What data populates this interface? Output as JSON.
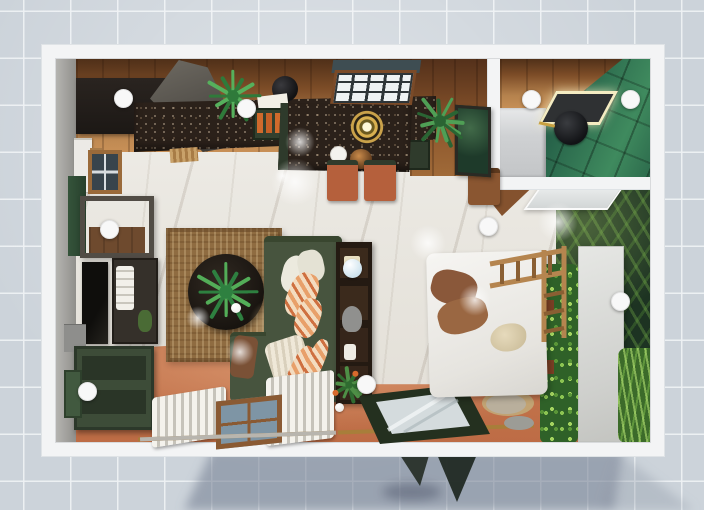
{
  "view": {
    "mode": "top-down-3d-apartment-render",
    "canvas_w": 704,
    "canvas_h": 510
  },
  "palette": {
    "canvas_grid": "#ccd3da",
    "grid_line": "#eef1f4",
    "wall": "#f3f4f5",
    "wood_floor": "#9a6a3c",
    "marble_floor": "#e9e7e2",
    "terracotta_floor": "#c0714a",
    "kitchen_granite": "#2b211a",
    "sofa_green": "#47543e",
    "cabinet_green": "#3d4c38",
    "bath_tile_green": "#2c6a4c",
    "palm_foliage": "#1d3322",
    "hedge_green": "#2f6128",
    "rug_jute": "#8f6c41",
    "shadow_blue": "#7b8597",
    "marker_white": "#f8f8f8",
    "lamp_gold": "#caa24a",
    "glass_table_frame": "#24301f"
  },
  "markers": [
    {
      "id": "kitchen-cabinets",
      "x": 122,
      "y": 97
    },
    {
      "id": "kitchen-plant",
      "x": 245,
      "y": 107
    },
    {
      "id": "bathroom-vanity",
      "x": 530,
      "y": 98
    },
    {
      "id": "bathroom-shower",
      "x": 629,
      "y": 98
    },
    {
      "id": "desk",
      "x": 108,
      "y": 228
    },
    {
      "id": "island-floor",
      "x": 487,
      "y": 225
    },
    {
      "id": "wardrobe",
      "x": 619,
      "y": 300
    },
    {
      "id": "sideboard",
      "x": 86,
      "y": 390
    },
    {
      "id": "shelf-plant",
      "x": 365,
      "y": 383
    }
  ],
  "plants": [
    {
      "id": "kitchen-counter",
      "x": 233,
      "y": 96,
      "r": 27,
      "c1": "#56b05c",
      "c2": "#2f7a3a",
      "petals": 16
    },
    {
      "id": "dining-palm",
      "x": 440,
      "y": 121,
      "r": 27,
      "c1": "#4f9f55",
      "c2": "#2a6433",
      "petals": 14
    },
    {
      "id": "coffee-table",
      "x": 226,
      "y": 292,
      "r": 31,
      "c1": "#53ad58",
      "c2": "#2e8040",
      "petals": 16
    },
    {
      "id": "shelf-flower",
      "x": 349,
      "y": 385,
      "r": 17,
      "c1": "#4e8f46",
      "c2": "#2f6b30",
      "petals": 12,
      "accent": "#d86a2c"
    }
  ],
  "decor_spheres": [
    {
      "id": "blue-ball",
      "x": 352,
      "y": 268,
      "d": 19,
      "color": "#cfe3ee"
    },
    {
      "id": "white-ball-rug",
      "x": 236,
      "y": 308,
      "d": 10,
      "color": "#f2f2f0"
    },
    {
      "id": "white-ball-floor",
      "x": 339,
      "y": 407,
      "d": 9,
      "color": "#eceae6"
    }
  ],
  "light_glints": [
    {
      "x": 295,
      "y": 182,
      "r": 24
    },
    {
      "x": 240,
      "y": 352,
      "r": 14
    },
    {
      "x": 428,
      "y": 243,
      "r": 18
    },
    {
      "x": 300,
      "y": 142,
      "r": 15
    },
    {
      "x": 558,
      "y": 222,
      "r": 20
    },
    {
      "x": 283,
      "y": 176,
      "r": 8
    },
    {
      "x": 198,
      "y": 318,
      "r": 12
    },
    {
      "x": 475,
      "y": 300,
      "r": 16
    }
  ]
}
